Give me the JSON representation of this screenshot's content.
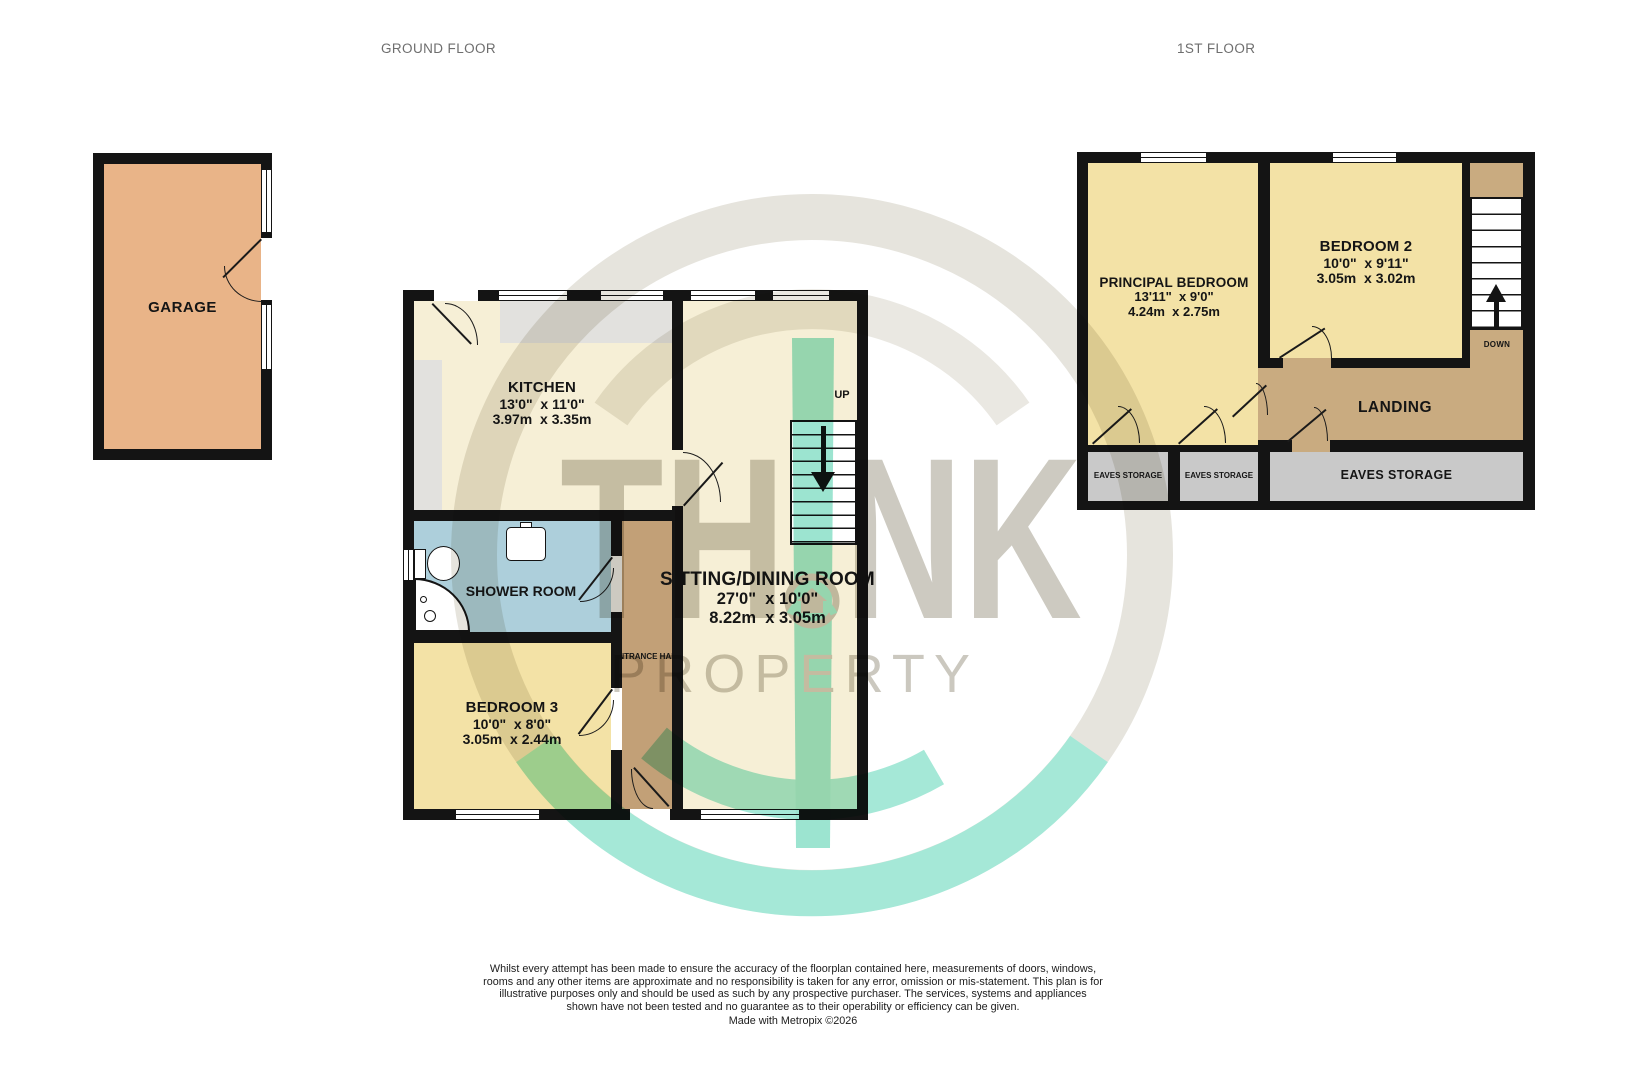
{
  "floors": {
    "ground": "GROUND FLOOR",
    "first": "1ST FLOOR"
  },
  "rooms": {
    "garage": {
      "name": "GARAGE"
    },
    "kitchen": {
      "name": "KITCHEN",
      "imperial": "13'0\"  x 11'0\"",
      "metric": "3.97m  x 3.35m"
    },
    "shower_room": {
      "name": "SHOWER ROOM"
    },
    "entrance_hall": {
      "name": "ENTRANCE HALL"
    },
    "bedroom3": {
      "name": "BEDROOM 3",
      "imperial": "10'0\"  x 8'0\"",
      "metric": "3.05m  x 2.44m"
    },
    "sitting_dining": {
      "name": "SITTING/DINING ROOM",
      "imperial": "27'0\"  x 10'0\"",
      "metric": "8.22m  x 3.05m"
    },
    "principal_bedroom": {
      "name": "PRINCIPAL BEDROOM",
      "imperial": "13'11\"  x 9'0\"",
      "metric": "4.24m  x 2.75m"
    },
    "bedroom2": {
      "name": "BEDROOM 2",
      "imperial": "10'0\"  x 9'11\"",
      "metric": "3.05m  x 3.02m"
    },
    "landing": {
      "name": "LANDING"
    },
    "eaves_storage_1": {
      "name": "EAVES STORAGE"
    },
    "eaves_storage_2": {
      "name": "EAVES STORAGE"
    },
    "eaves_storage_3": {
      "name": "EAVES STORAGE"
    }
  },
  "stairs": {
    "up_label": "UP",
    "down_label": "DOWN"
  },
  "watermark": {
    "think_left": "TH",
    "think_right": "NK",
    "property": "PROPERTY"
  },
  "disclaimer": {
    "text": "Whilst every attempt has been made to ensure the accuracy of the floorplan contained here, measurements of doors, windows, rooms and any other items are approximate and no responsibility is taken for any error, omission or mis-statement. This plan is for illustrative purposes only and should be used as such by any prospective purchaser. The services, systems and appliances shown have not been tested and no guarantee as to their operability or efficiency can be given.",
    "credit": "Made with Metropix ©2026"
  },
  "colors": {
    "wall": "#141414",
    "cream": "#F6EFD6",
    "yellow": "#F3E2A6",
    "garage_tan": "#E9B488",
    "hall_tan": "#C2A077",
    "landing_tan": "#C9AB80",
    "eaves_gray": "#C9C9C9",
    "shower_blue": "#ADCFDB",
    "counter_gray": "#E2E1DE",
    "watermark_gray": "#CDCAC1",
    "watermark_teal": "#9CE4D0",
    "title_gray": "#6E6E6E"
  }
}
